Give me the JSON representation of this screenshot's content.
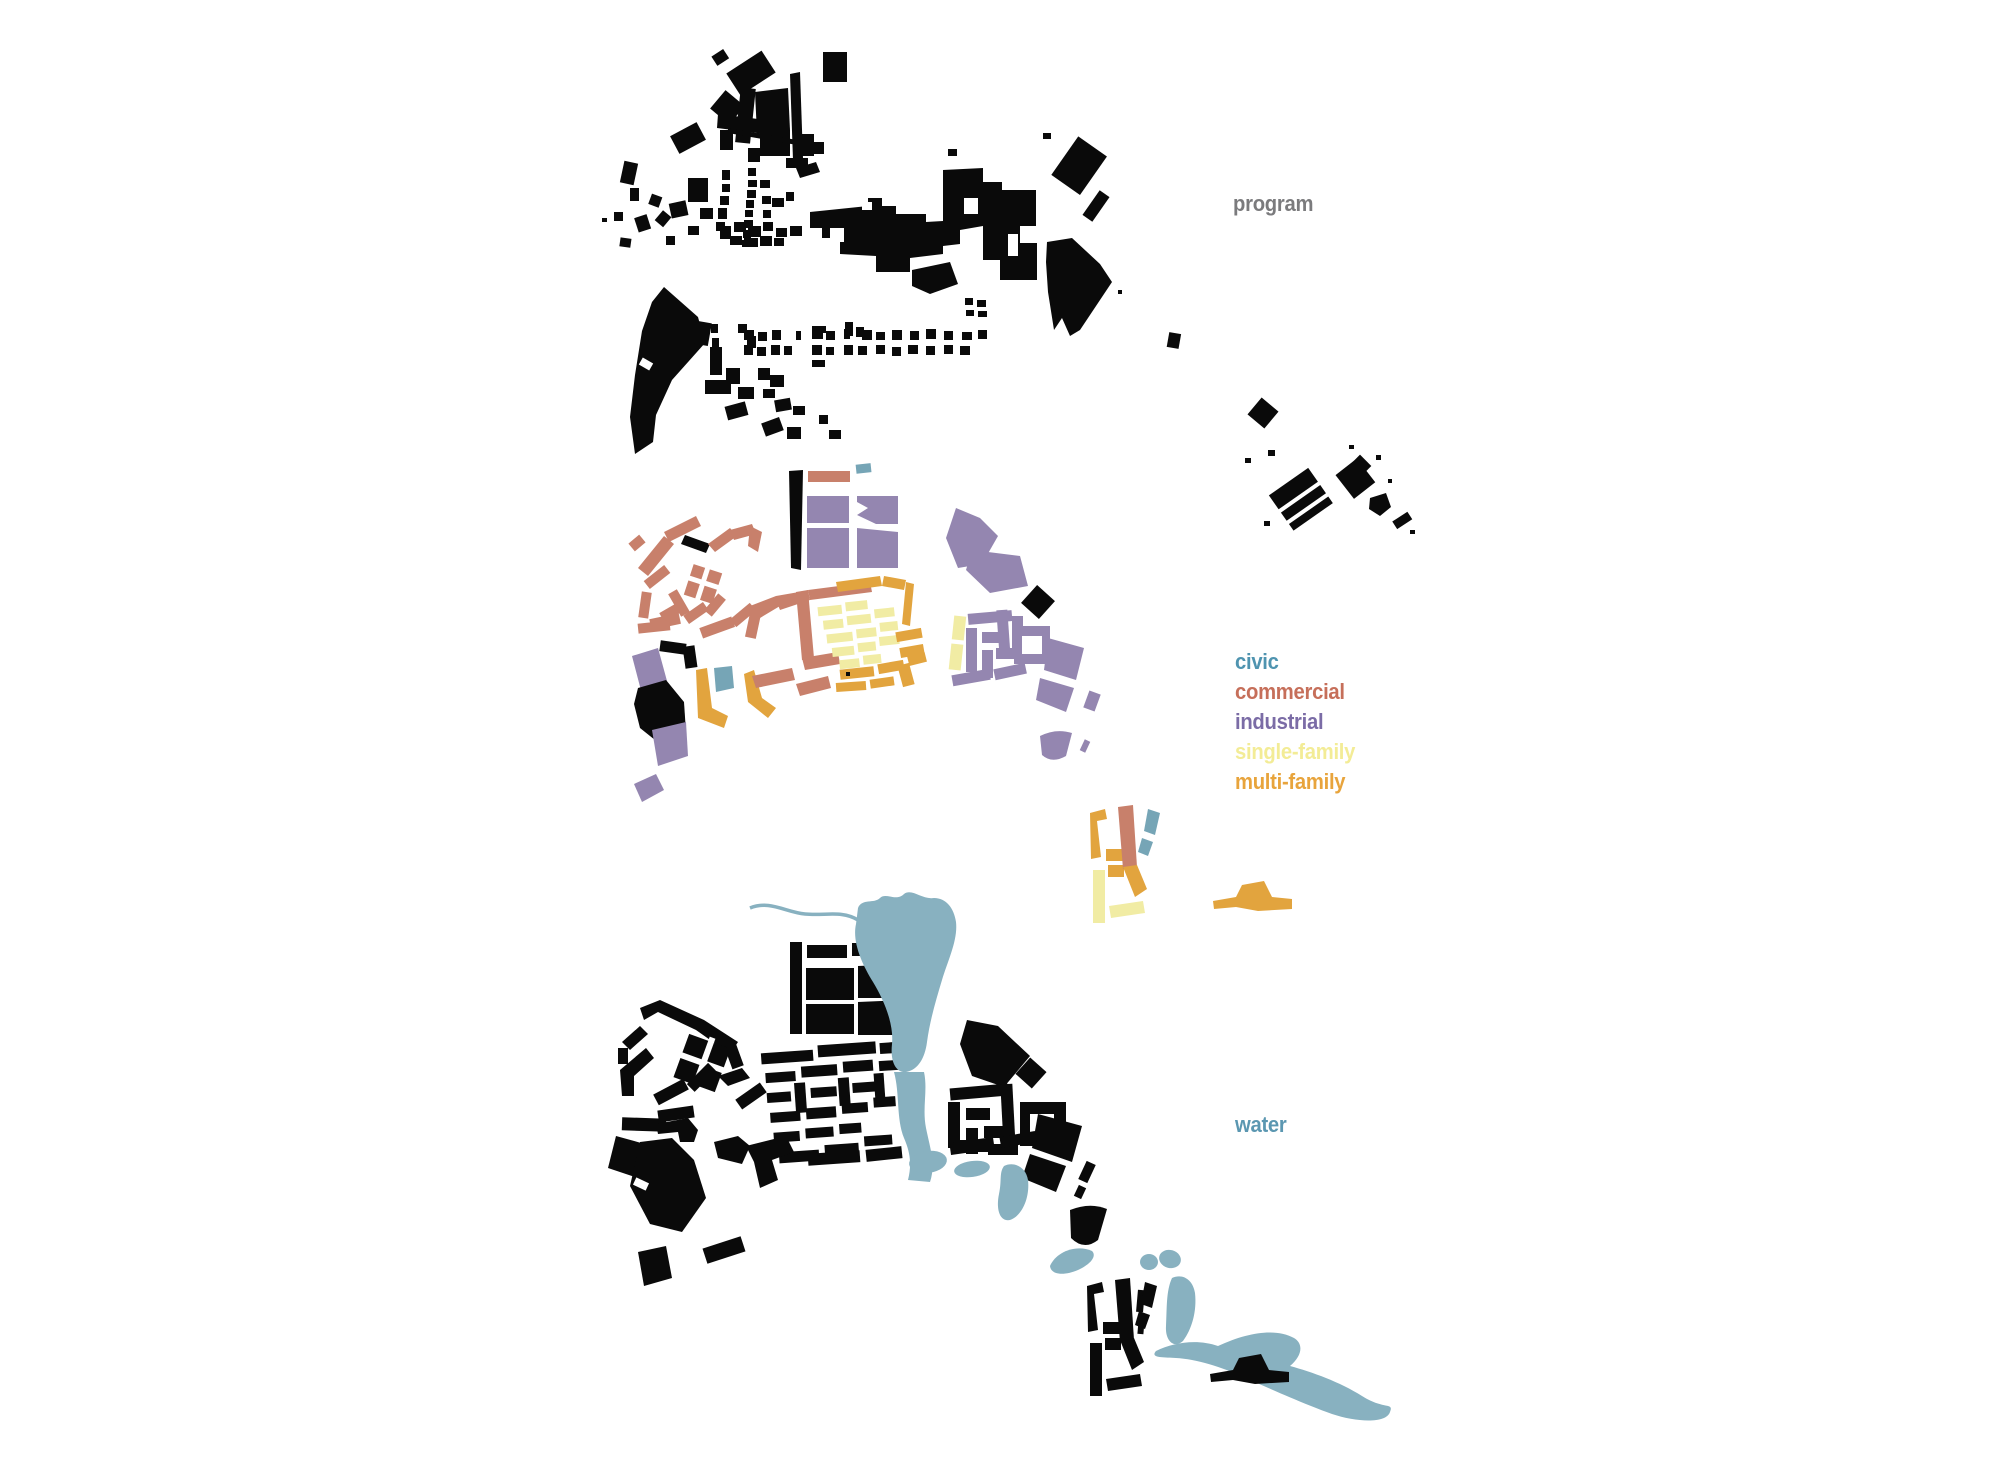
{
  "labels": {
    "program": "program",
    "water": "water"
  },
  "legend": {
    "items": [
      {
        "id": "civic",
        "label": "civic",
        "color": "#4f94b0"
      },
      {
        "id": "commercial",
        "label": "commercial",
        "color": "#c66f5a"
      },
      {
        "id": "industrial",
        "label": "industrial",
        "color": "#7b6ca6"
      },
      {
        "id": "single-family",
        "label": "single-family",
        "color": "#f3ec96"
      },
      {
        "id": "multi-family",
        "label": "multi-family",
        "color": "#e8a43c"
      }
    ]
  },
  "palette": {
    "background": "#ffffff",
    "building_black": "#0a0a0a",
    "program_label_color": "#7b7b7d",
    "water_label_color": "#5b97b1",
    "civic_fill": "#76a5b6",
    "commercial_fill": "#c8806b",
    "industrial_fill": "#9486b0",
    "single_family_fill": "#f1eca4",
    "multi_family_fill": "#e2a43e",
    "water_fill": "#88b1c0"
  }
}
